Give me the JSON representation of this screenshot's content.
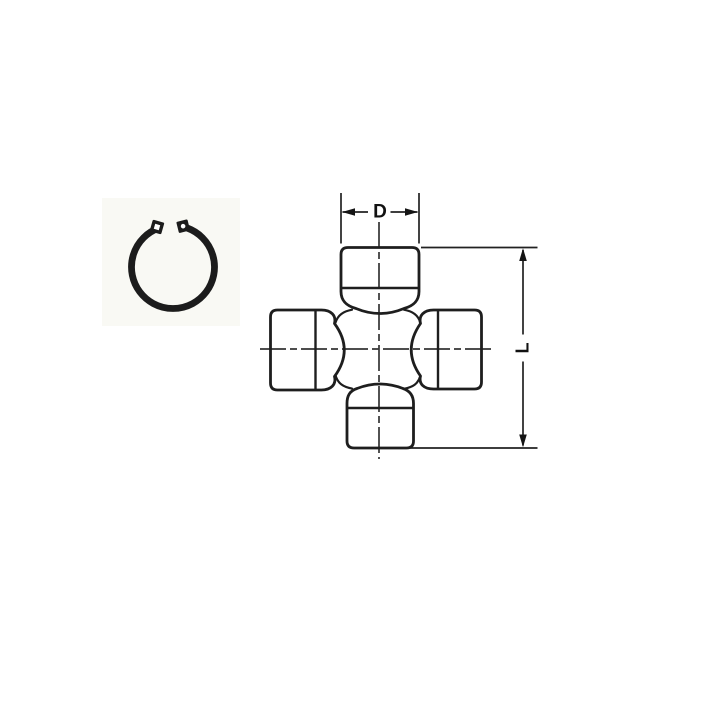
{
  "figure": {
    "title": "Universal joint cross technical drawing with snap ring",
    "dimensions": {
      "cup_diameter_label": "D",
      "overall_length_label": "L"
    },
    "icons": {
      "snap_ring": "snap-ring-icon",
      "ujoint_cross": "universal-joint-cross-drawing"
    },
    "colors": {
      "line": "#1e1e1e",
      "centerline": "#343434",
      "background": "#ffffff",
      "ring_area_tint": "#f9f9f4"
    }
  }
}
